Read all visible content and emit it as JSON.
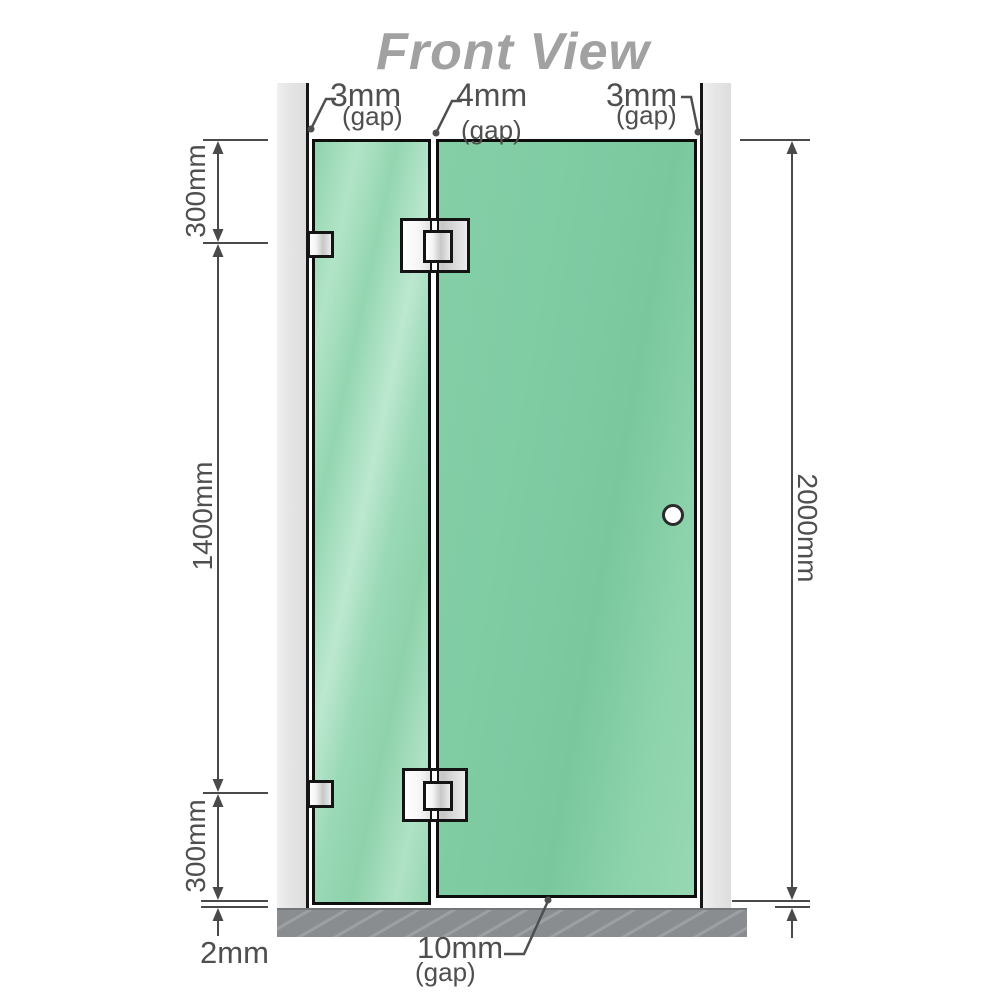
{
  "title": "Front View",
  "colors": {
    "glass_door": "#7dcaa1",
    "glass_left": "#9ad9b6",
    "wall": "#e5e5e5",
    "floor": "#8a8d90",
    "dimension": "#4f4f4f",
    "title_gray": "#a1a1a1"
  },
  "dimensions": {
    "top_gaps": [
      {
        "value": "3mm",
        "label": "(gap)"
      },
      {
        "value": "4mm",
        "label": "(gap)"
      },
      {
        "value": "3mm",
        "label": "(gap)"
      }
    ],
    "left_top": "300mm",
    "left_middle": "1400mm",
    "left_bottom": "300mm",
    "floor_gap": "2mm",
    "bottom_gap": {
      "value": "10mm",
      "label": "(gap)"
    },
    "total_height": "2000mm"
  }
}
